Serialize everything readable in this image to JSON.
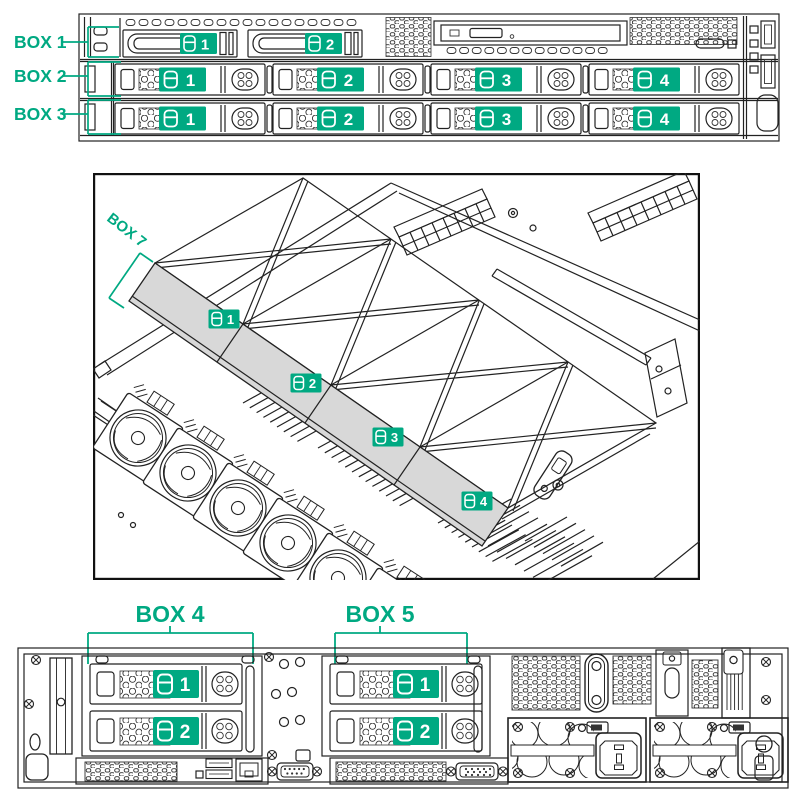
{
  "colors": {
    "accent": "#00A982",
    "line": "#222222",
    "cage_face": "#d8d8d8",
    "badge_text": "#ffffff"
  },
  "icons": {
    "drive_bay": "drive-icon"
  },
  "front_view": {
    "boxes": [
      {
        "label": "BOX 1",
        "drives": [
          "1",
          "2"
        ]
      },
      {
        "label": "BOX 2",
        "drives": [
          "1",
          "2",
          "3",
          "4"
        ]
      },
      {
        "label": "BOX 3",
        "drives": [
          "1",
          "2",
          "3",
          "4"
        ]
      }
    ]
  },
  "internal_view": {
    "box": {
      "label": "BOX 7",
      "drives": [
        "1",
        "2",
        "3",
        "4"
      ]
    }
  },
  "rear_view": {
    "boxes": [
      {
        "label": "BOX 4",
        "drives": [
          "1",
          "2"
        ]
      },
      {
        "label": "BOX 5",
        "drives": [
          "1",
          "2"
        ]
      }
    ]
  }
}
